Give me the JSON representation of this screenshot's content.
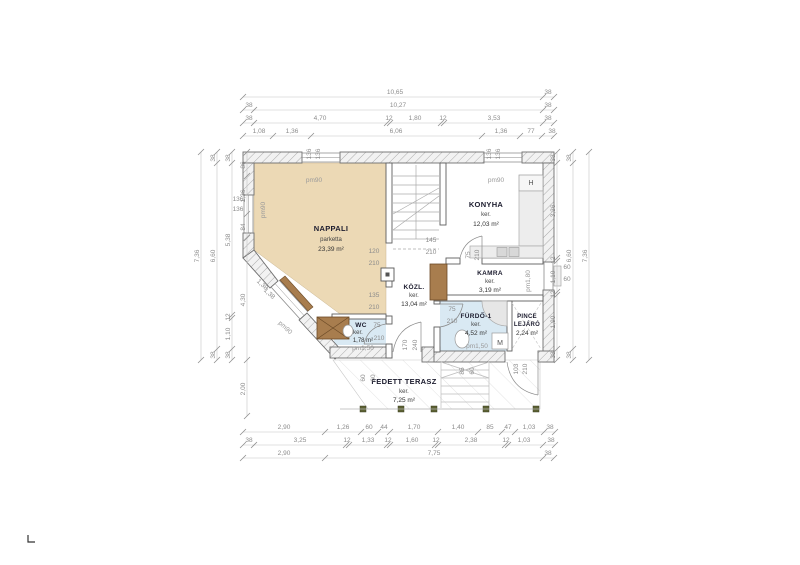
{
  "plan": {
    "rooms": {
      "nappali": {
        "name": "NAPPALI",
        "finish": "parketta",
        "area": "23,39 m²"
      },
      "konyha": {
        "name": "KONYHA",
        "finish": "ker.",
        "area": "12,03 m²"
      },
      "kozl": {
        "name": "KÖZL.",
        "finish": "ker.",
        "area": "13,04 m²"
      },
      "kamra": {
        "name": "KAMRA",
        "finish": "ker.",
        "area": "3,19 m²"
      },
      "furdo": {
        "name": "FÜRDŐ-1",
        "finish": "ker.",
        "area": "4,52 m²"
      },
      "pince": {
        "name": "PINCE",
        "name2": "LEJÁRÓ",
        "area": "2,24 m²"
      },
      "wc": {
        "name": "WC",
        "finish": "ker.",
        "area": "1,78 m²"
      },
      "terasz": {
        "name": "FEDETT TERASZ",
        "finish": "ker.",
        "area": "7,25 m²"
      }
    },
    "fixtures": {
      "fridge": "H",
      "washer": "M"
    },
    "colors": {
      "room_fill": "#ecd9b5",
      "wet_fill": "#d9e9f3",
      "wood": "#a87d4e",
      "dim_text": "#8c8c8c"
    },
    "dim_labels": [
      {
        "x": 395,
        "y": 94,
        "r": 0,
        "t": "10,65"
      },
      {
        "x": 548,
        "y": 94,
        "r": 0,
        "t": "38"
      },
      {
        "x": 249,
        "y": 107,
        "r": 0,
        "t": "38"
      },
      {
        "x": 398,
        "y": 107,
        "r": 0,
        "t": "10,27"
      },
      {
        "x": 548,
        "y": 107,
        "r": 0,
        "t": "38"
      },
      {
        "x": 249,
        "y": 120,
        "r": 0,
        "t": "38"
      },
      {
        "x": 320,
        "y": 120,
        "r": 0,
        "t": "4,70"
      },
      {
        "x": 389,
        "y": 120,
        "r": 0,
        "t": "12"
      },
      {
        "x": 415,
        "y": 120,
        "r": 0,
        "t": "1,80"
      },
      {
        "x": 443,
        "y": 120,
        "r": 0,
        "t": "12"
      },
      {
        "x": 494,
        "y": 120,
        "r": 0,
        "t": "3,53"
      },
      {
        "x": 548,
        "y": 120,
        "r": 0,
        "t": "38"
      },
      {
        "x": 259,
        "y": 133,
        "r": 0,
        "t": "1,08"
      },
      {
        "x": 292,
        "y": 133,
        "r": 0,
        "t": "1,36"
      },
      {
        "x": 396,
        "y": 133,
        "r": 0,
        "t": "6,06"
      },
      {
        "x": 501,
        "y": 133,
        "r": 0,
        "t": "1,36"
      },
      {
        "x": 531,
        "y": 133,
        "r": 0,
        "t": "77"
      },
      {
        "x": 552,
        "y": 133,
        "r": 0,
        "t": "38"
      },
      {
        "x": 199,
        "y": 256,
        "r": -90,
        "t": "7,36"
      },
      {
        "x": 215,
        "y": 158,
        "r": -90,
        "t": "38"
      },
      {
        "x": 215,
        "y": 256,
        "r": -90,
        "t": "6,60"
      },
      {
        "x": 215,
        "y": 355,
        "r": -90,
        "t": "38"
      },
      {
        "x": 230,
        "y": 158,
        "r": -90,
        "t": "38"
      },
      {
        "x": 230,
        "y": 240,
        "r": -90,
        "t": "5,38"
      },
      {
        "x": 230,
        "y": 317,
        "r": -90,
        "t": "12"
      },
      {
        "x": 230,
        "y": 334,
        "r": -90,
        "t": "1,10"
      },
      {
        "x": 230,
        "y": 355,
        "r": -90,
        "t": "38"
      },
      {
        "x": 245,
        "y": 165,
        "r": -90,
        "t": "86"
      },
      {
        "x": 245,
        "y": 196,
        "r": -90,
        "t": "1,36"
      },
      {
        "x": 245,
        "y": 227,
        "r": -90,
        "t": "84"
      },
      {
        "x": 245,
        "y": 300,
        "r": -90,
        "t": "4,30"
      },
      {
        "x": 245,
        "y": 389,
        "r": -90,
        "t": "2,00"
      },
      {
        "x": 238,
        "y": 201,
        "r": 0,
        "t": "136"
      },
      {
        "x": 238,
        "y": 211,
        "r": 0,
        "t": "136"
      },
      {
        "x": 555,
        "y": 158,
        "r": -90,
        "t": "38"
      },
      {
        "x": 555,
        "y": 211,
        "r": -90,
        "t": "3,36"
      },
      {
        "x": 555,
        "y": 260,
        "r": -90,
        "t": "12"
      },
      {
        "x": 555,
        "y": 277,
        "r": -90,
        "t": "1,10"
      },
      {
        "x": 555,
        "y": 294,
        "r": -90,
        "t": "12"
      },
      {
        "x": 555,
        "y": 322,
        "r": -90,
        "t": "1,90"
      },
      {
        "x": 555,
        "y": 355,
        "r": -90,
        "t": "38"
      },
      {
        "x": 571,
        "y": 158,
        "r": -90,
        "t": "38"
      },
      {
        "x": 571,
        "y": 256,
        "r": -90,
        "t": "6,60"
      },
      {
        "x": 571,
        "y": 355,
        "r": -90,
        "t": "38"
      },
      {
        "x": 587,
        "y": 256,
        "r": -90,
        "t": "7,36"
      },
      {
        "x": 567,
        "y": 269,
        "r": 0,
        "t": "60"
      },
      {
        "x": 567,
        "y": 281,
        "r": 0,
        "t": "60"
      },
      {
        "x": 284,
        "y": 429,
        "r": 0,
        "t": "2,90"
      },
      {
        "x": 343,
        "y": 429,
        "r": 0,
        "t": "1,26"
      },
      {
        "x": 369,
        "y": 429,
        "r": 0,
        "t": "60"
      },
      {
        "x": 384,
        "y": 429,
        "r": 0,
        "t": "44"
      },
      {
        "x": 414,
        "y": 429,
        "r": 0,
        "t": "1,70"
      },
      {
        "x": 458,
        "y": 429,
        "r": 0,
        "t": "1,40"
      },
      {
        "x": 490,
        "y": 429,
        "r": 0,
        "t": "85"
      },
      {
        "x": 508,
        "y": 429,
        "r": 0,
        "t": "47"
      },
      {
        "x": 529,
        "y": 429,
        "r": 0,
        "t": "1,03"
      },
      {
        "x": 550,
        "y": 429,
        "r": 0,
        "t": "38"
      },
      {
        "x": 249,
        "y": 442,
        "r": 0,
        "t": "38"
      },
      {
        "x": 300,
        "y": 442,
        "r": 0,
        "t": "3,25"
      },
      {
        "x": 347,
        "y": 442,
        "r": 0,
        "t": "12"
      },
      {
        "x": 368,
        "y": 442,
        "r": 0,
        "t": "1,33"
      },
      {
        "x": 388,
        "y": 442,
        "r": 0,
        "t": "12"
      },
      {
        "x": 412,
        "y": 442,
        "r": 0,
        "t": "1,60"
      },
      {
        "x": 436,
        "y": 442,
        "r": 0,
        "t": "12"
      },
      {
        "x": 471,
        "y": 442,
        "r": 0,
        "t": "2,38"
      },
      {
        "x": 506,
        "y": 442,
        "r": 0,
        "t": "12"
      },
      {
        "x": 524,
        "y": 442,
        "r": 0,
        "t": "1,03"
      },
      {
        "x": 551,
        "y": 442,
        "r": 0,
        "t": "38"
      },
      {
        "x": 284,
        "y": 455,
        "r": 0,
        "t": "2,90"
      },
      {
        "x": 434,
        "y": 455,
        "r": 0,
        "t": "7,75"
      },
      {
        "x": 548,
        "y": 455,
        "r": 0,
        "t": "38"
      },
      {
        "x": 311,
        "y": 154,
        "r": -90,
        "t": "136"
      },
      {
        "x": 320,
        "y": 154,
        "r": -90,
        "t": "136"
      },
      {
        "x": 491,
        "y": 154,
        "r": -90,
        "t": "136"
      },
      {
        "x": 500,
        "y": 154,
        "r": -90,
        "t": "136"
      },
      {
        "x": 374,
        "y": 253,
        "r": 0,
        "t": "120"
      },
      {
        "x": 374,
        "y": 265,
        "r": 0,
        "t": "210"
      },
      {
        "x": 374,
        "y": 297,
        "r": 0,
        "t": "135"
      },
      {
        "x": 374,
        "y": 309,
        "r": 0,
        "t": "210"
      },
      {
        "x": 431,
        "y": 242,
        "r": 0,
        "t": "145"
      },
      {
        "x": 431,
        "y": 254,
        "r": 0,
        "t": "210"
      },
      {
        "x": 470,
        "y": 255,
        "r": -90,
        "t": "75"
      },
      {
        "x": 479,
        "y": 255,
        "r": -90,
        "t": "210"
      },
      {
        "x": 377,
        "y": 327,
        "r": 0,
        "t": "75"
      },
      {
        "x": 379,
        "y": 340,
        "r": 0,
        "t": "210"
      },
      {
        "x": 452,
        "y": 311,
        "r": 0,
        "t": "75"
      },
      {
        "x": 452,
        "y": 323,
        "r": 0,
        "t": "210"
      },
      {
        "x": 407,
        "y": 345,
        "r": -90,
        "t": "170"
      },
      {
        "x": 417,
        "y": 345,
        "r": -90,
        "t": "240"
      },
      {
        "x": 518,
        "y": 369,
        "r": -90,
        "t": "103"
      },
      {
        "x": 527,
        "y": 369,
        "r": -90,
        "t": "210"
      },
      {
        "x": 464,
        "y": 371,
        "r": -90,
        "t": "85"
      },
      {
        "x": 474,
        "y": 371,
        "r": -90,
        "t": "60"
      },
      {
        "x": 365,
        "y": 378,
        "r": -90,
        "t": "60"
      },
      {
        "x": 375,
        "y": 378,
        "r": -90,
        "t": "60"
      },
      {
        "x": 261,
        "y": 286,
        "r": 43,
        "t": "1,38"
      },
      {
        "x": 268,
        "y": 295,
        "r": 43,
        "t": "1,38"
      }
    ],
    "pm_labels": [
      {
        "x": 314,
        "y": 182,
        "r": 0,
        "t": "pm90"
      },
      {
        "x": 496,
        "y": 182,
        "r": 0,
        "t": "pm90"
      },
      {
        "x": 265,
        "y": 210,
        "r": -90,
        "t": "pm90"
      },
      {
        "x": 284,
        "y": 329,
        "r": 43,
        "t": "pm90"
      },
      {
        "x": 530,
        "y": 281,
        "r": -90,
        "t": "pm1,80"
      },
      {
        "x": 363,
        "y": 350,
        "r": 0,
        "t": "pm1,50"
      },
      {
        "x": 477,
        "y": 348,
        "r": 0,
        "t": "pm1,50"
      }
    ],
    "dim_lines": [
      {
        "o": "h",
        "y": 97,
        "x1": 243,
        "x2": 554,
        "t": [
          243,
          543,
          554
        ]
      },
      {
        "o": "h",
        "y": 110,
        "x1": 243,
        "x2": 554,
        "t": [
          243,
          254,
          543,
          554
        ]
      },
      {
        "o": "h",
        "y": 123,
        "x1": 243,
        "x2": 554,
        "t": [
          243,
          254,
          387,
          390,
          441,
          444,
          543,
          554
        ]
      },
      {
        "o": "h",
        "y": 136,
        "x1": 243,
        "x2": 554,
        "t": [
          243,
          273,
          311,
          482,
          520,
          542,
          554
        ]
      },
      {
        "o": "h",
        "y": 432,
        "x1": 243,
        "x2": 555,
        "t": [
          243,
          325,
          361,
          378,
          390,
          438,
          478,
          502,
          515,
          544,
          555
        ]
      },
      {
        "o": "h",
        "y": 445,
        "x1": 243,
        "x2": 555,
        "t": [
          243,
          254,
          346,
          349,
          387,
          390,
          435,
          438,
          505,
          508,
          543,
          555
        ]
      },
      {
        "o": "h",
        "y": 458,
        "x1": 243,
        "x2": 554,
        "t": [
          243,
          325,
          543,
          554
        ]
      },
      {
        "o": "v",
        "x": 201,
        "y1": 152,
        "y2": 360,
        "t": [
          152,
          360
        ]
      },
      {
        "o": "v",
        "x": 217,
        "y1": 152,
        "y2": 360,
        "t": [
          152,
          163,
          349,
          360
        ]
      },
      {
        "o": "v",
        "x": 232,
        "y1": 152,
        "y2": 360,
        "t": [
          152,
          163,
          315,
          318,
          349,
          360
        ]
      },
      {
        "o": "v",
        "x": 247,
        "y1": 152,
        "y2": 416,
        "t": [
          152,
          176,
          214,
          238,
          360,
          416
        ]
      },
      {
        "o": "v",
        "x": 557,
        "y1": 152,
        "y2": 360,
        "t": [
          152,
          163,
          258,
          261,
          292,
          295,
          349,
          360
        ]
      },
      {
        "o": "v",
        "x": 573,
        "y1": 152,
        "y2": 360,
        "t": [
          152,
          163,
          349,
          360
        ]
      },
      {
        "o": "v",
        "x": 589,
        "y1": 152,
        "y2": 360,
        "t": [
          152,
          360
        ]
      }
    ]
  }
}
